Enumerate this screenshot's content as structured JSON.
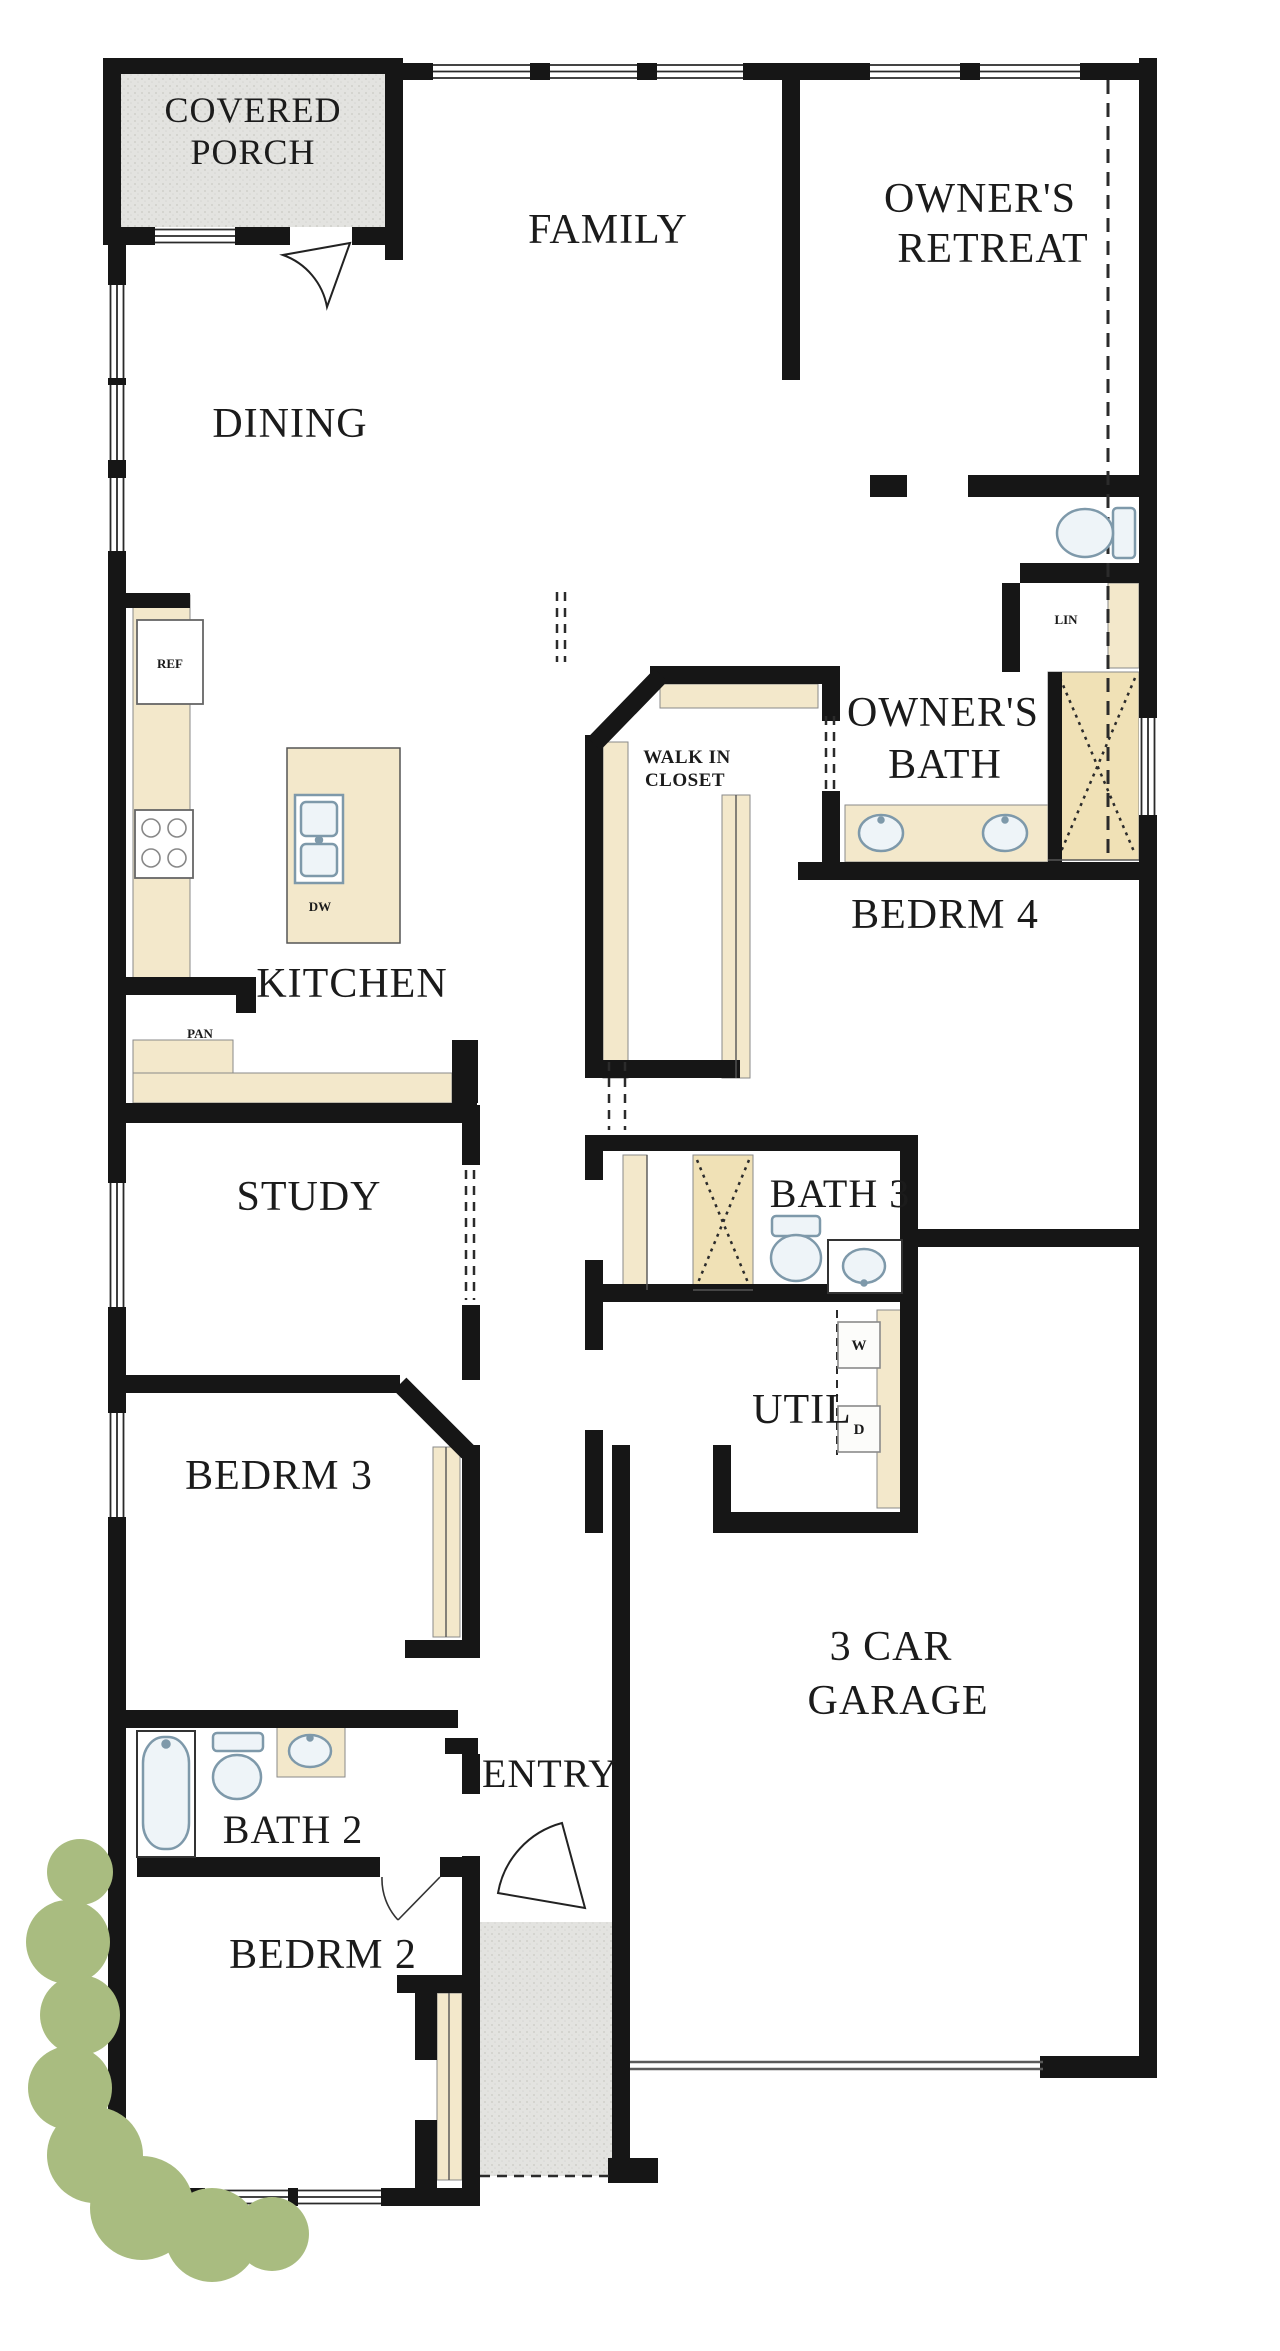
{
  "plan": {
    "type": "residential-floor-plan",
    "rooms": {
      "covered_porch": {
        "line1": "COVERED",
        "line2": "PORCH"
      },
      "family": "FAMILY",
      "owners_retreat": {
        "line1": "OWNER'S",
        "line2": "RETREAT"
      },
      "dining": "DINING",
      "walk_in_closet": {
        "line1": "WALK IN",
        "line2": "CLOSET"
      },
      "owners_bath": {
        "line1": "OWNER'S",
        "line2": "BATH"
      },
      "kitchen": "KITCHEN",
      "bedrm4": "BEDRM 4",
      "study": "STUDY",
      "bath3": "BATH 3",
      "util": "UTIL",
      "bedrm3": "BEDRM 3",
      "garage": {
        "line1": "3 CAR",
        "line2": "GARAGE"
      },
      "entry": "ENTRY",
      "bath2": "BATH 2",
      "bedrm2": "BEDRM 2"
    },
    "features": {
      "refrigerator": "REF",
      "dishwasher": "DW",
      "pantry": "PAN",
      "linen": "LIN",
      "washer": "W",
      "dryer": "D"
    },
    "colors": {
      "wall": "#161616",
      "porch_fill": "#e3e3e0",
      "counter_fill": "#f3e8cb",
      "shower_fill": "#f0e1b6",
      "fixture_fill": "#eef4f8",
      "fixture_stroke": "#7e99aa",
      "shrub_fill": "#a9bc80",
      "label_color": "#1b1b1b"
    }
  }
}
